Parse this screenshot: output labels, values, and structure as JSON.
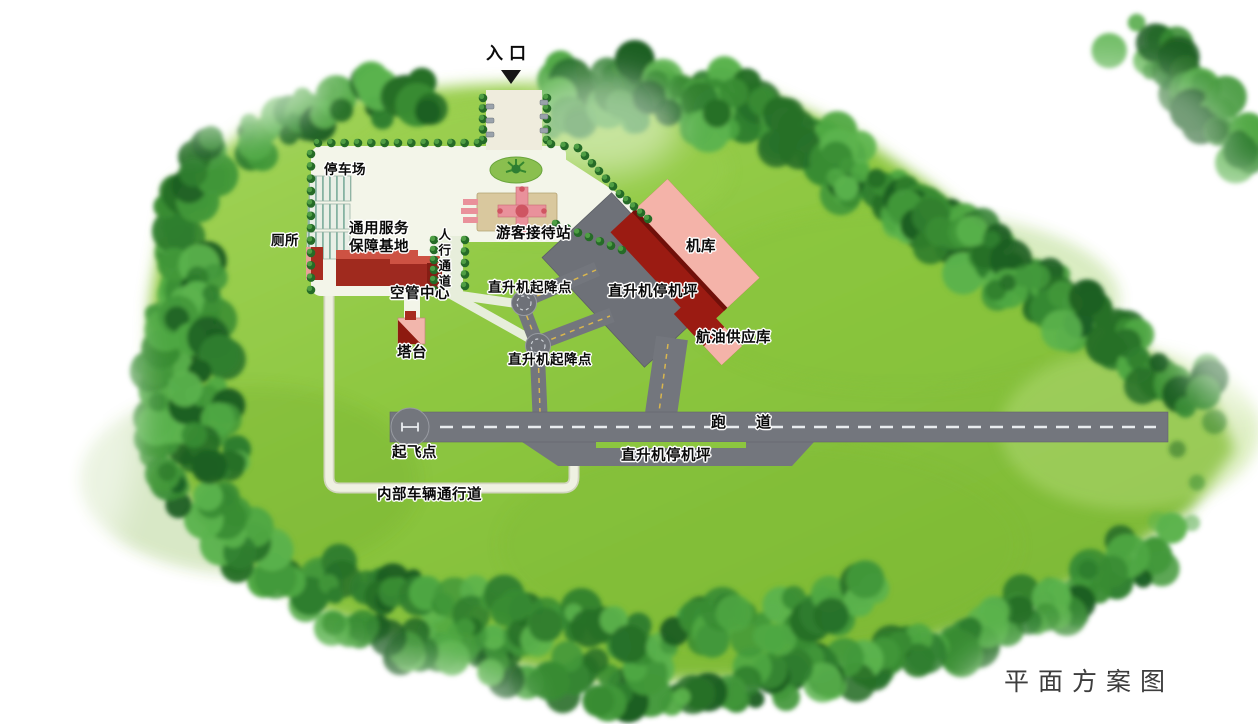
{
  "page": {
    "caption": "平面方案图"
  },
  "map": {
    "entrance": {
      "label": "入口"
    },
    "facilities": {
      "parking": "停车场",
      "toilet": "厕所",
      "service_base": "通用服务\n保障基地",
      "pedestrian_walkway": "人行通道",
      "visitor_reception": "游客接待站",
      "hangar": "机库",
      "atc_center": "空管中心",
      "helipad_upper": "直升机起降点",
      "helicopter_apron": "直升机停机坪",
      "fuel_depot": "航油供应库",
      "control_tower": "塔台",
      "helipad_lower": "直升机起降点",
      "runway": "跑道",
      "takeoff_point": "起飞点",
      "helicopter_apron_south": "直升机停机坪",
      "internal_vehicle_road": "内部车辆通行道"
    },
    "colors": {
      "grass": "#8cc63f",
      "forest": "#2f7e2e",
      "pavement": "#73767d",
      "plaza": "#f3f5e9",
      "building_red": "#9e2920",
      "building_pink": "#f4b3a9",
      "lane_marking_yellow": "#d9b64e",
      "lane_marking_white": "#e9ecef"
    }
  }
}
